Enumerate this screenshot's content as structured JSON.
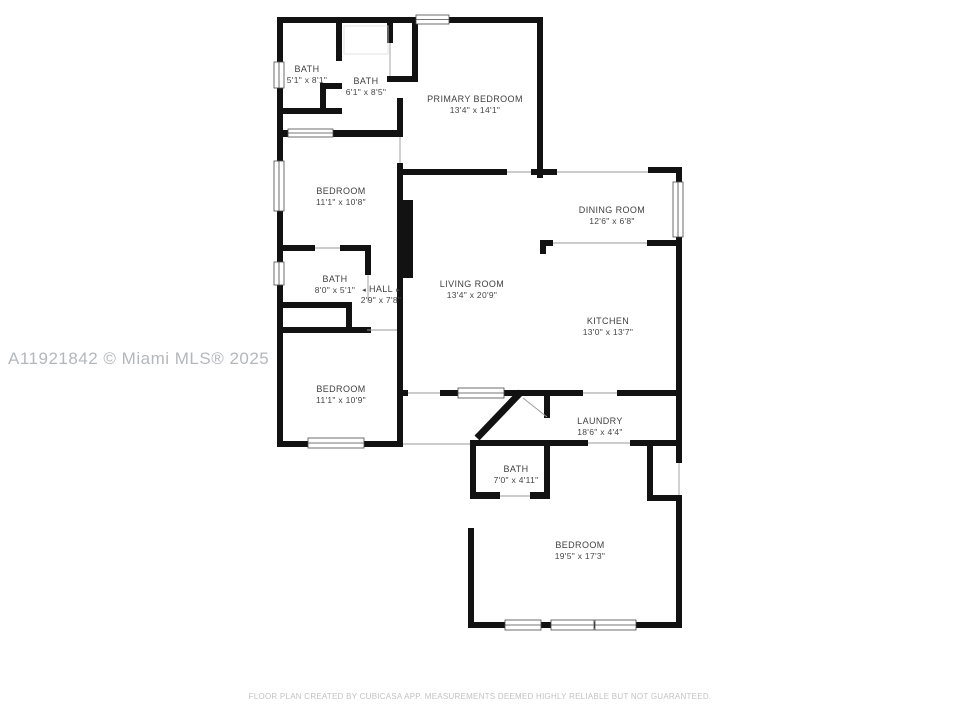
{
  "rooms": [
    {
      "id": "bath-1",
      "name": "BATH",
      "dims": "5'1\" x 8'1\""
    },
    {
      "id": "bath-2",
      "name": "BATH",
      "dims": "6'1\" x 8'5\""
    },
    {
      "id": "primary-bedroom",
      "name": "PRIMARY BEDROOM",
      "dims": "13'4\" x 14'1\""
    },
    {
      "id": "bedroom-upper",
      "name": "BEDROOM",
      "dims": "11'1\" x 10'8\""
    },
    {
      "id": "dining-room",
      "name": "DINING ROOM",
      "dims": "12'6\" x 6'8\""
    },
    {
      "id": "bath-3",
      "name": "BATH",
      "dims": "8'0\" x 5'1\""
    },
    {
      "id": "hall",
      "name": "HALL",
      "dims": "2'9\" x 7'8\""
    },
    {
      "id": "living-room",
      "name": "LIVING ROOM",
      "dims": "13'4\" x 20'9\""
    },
    {
      "id": "kitchen",
      "name": "KITCHEN",
      "dims": "13'0\" x 13'7\""
    },
    {
      "id": "bedroom-middle",
      "name": "BEDROOM",
      "dims": "11'1\" x 10'9\""
    },
    {
      "id": "laundry",
      "name": "LAUNDRY",
      "dims": "18'6\" x 4'4\""
    },
    {
      "id": "bath-4",
      "name": "BATH",
      "dims": "7'0\" x 4'11\""
    },
    {
      "id": "bedroom-lower",
      "name": "BEDROOM",
      "dims": "19'5\" x 17'3\""
    }
  ],
  "icons": {
    "hall_arrow_left": "◂",
    "hall_arrow_right": "▸"
  },
  "watermark": "A11921842 © Miami MLS® 2025",
  "footer": "FLOOR PLAN CREATED BY CUBICASA APP. MEASUREMENTS DEEMED HIGHLY RELIABLE BUT NOT GUARANTEED.",
  "colors": {
    "wall": "#121212",
    "label": "#3f3f3f",
    "watermark": "#b4b7bb",
    "footer": "#c3c3c3",
    "background": "#ffffff"
  }
}
